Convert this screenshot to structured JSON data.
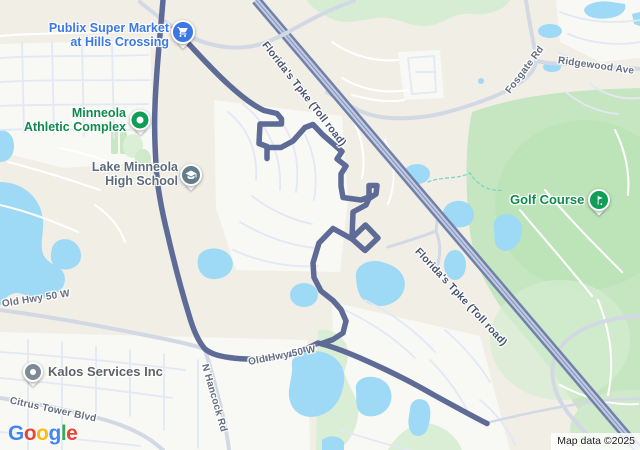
{
  "pois": {
    "publix": {
      "line1": "Publix Super Market",
      "line2": "at Hills Crossing",
      "color": "#3b78e4",
      "icon": "shopping-cart"
    },
    "athletic": {
      "line1": "Minneola",
      "line2": "Athletic Complex",
      "color": "#0f9d58",
      "icon": "park-dot"
    },
    "school": {
      "line1": "Lake Minneola",
      "line2": "High School",
      "color": "#607d8b",
      "icon": "graduation-cap"
    },
    "golf": {
      "label": "Golf Course",
      "color": "#0f9d58",
      "icon": "golf-flag"
    },
    "kalos": {
      "label": "Kalos Services Inc",
      "color": "#7e8a97",
      "icon": "generic-dot"
    }
  },
  "roads": {
    "tpke1": "Florida's Tpke (Toll road)",
    "tpke2": "Florida's Tpke (Toll road)",
    "fosgate": "Fosgate Rd",
    "ridgewood": "Ridgewood Ave",
    "old50_left": "Old Hwy 50 W",
    "old50_mid": "Old Hwy 50 W",
    "hancock": "N Hancock Rd",
    "citrus": "Citrus Tower Blvd"
  },
  "colors": {
    "route": "#5d6b96",
    "highway": "#7182aa",
    "highway_inner": "#c3cce2",
    "water": "#9ed9f5",
    "park": "#c6e6c1",
    "land": "#f1eee6",
    "poi_blue": "#3b78e4",
    "poi_green": "#0f9d58",
    "poi_school": "#607d8b",
    "poi_gray": "#7e8a97"
  },
  "footer": {
    "logo_letters": [
      "G",
      "o",
      "o",
      "g",
      "l",
      "e"
    ],
    "logo_colors": [
      "#4285F4",
      "#EA4335",
      "#FBBC05",
      "#4285F4",
      "#34A853",
      "#EA4335"
    ],
    "attribution": "Map data ©2025"
  }
}
